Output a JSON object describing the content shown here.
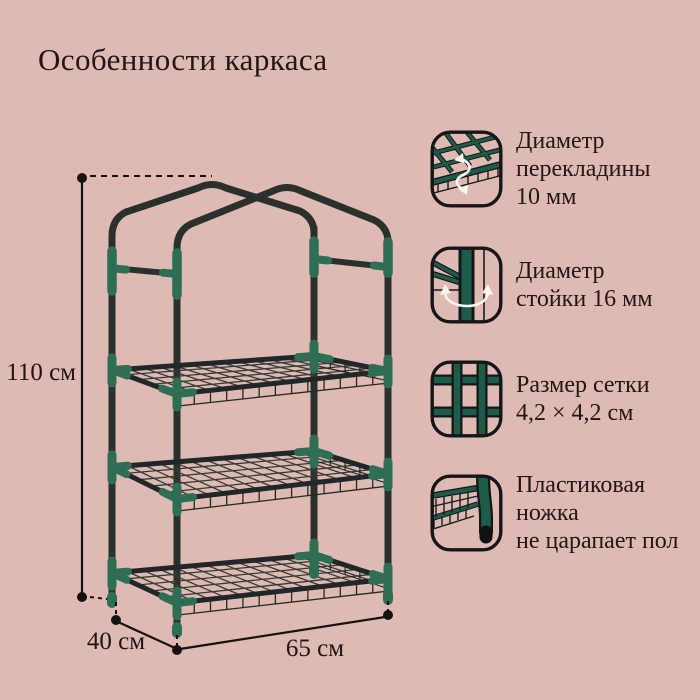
{
  "title": "Особенности каркаса",
  "colors": {
    "background": "#debab3",
    "tube_dark_green": "#2a302c",
    "connector_teal": "#2d6e55",
    "icon_green": "#1e5c49",
    "text": "#20161a",
    "arrow_white": "#fbf6f1"
  },
  "dimensions": {
    "height_label": "110 см",
    "depth_label": "40 см",
    "width_label": "65 см"
  },
  "features": [
    {
      "icon": "crossbar-diameter-icon",
      "lines": [
        "Диаметр",
        "перекладины",
        "10 мм"
      ]
    },
    {
      "icon": "post-diameter-icon",
      "lines": [
        "Диаметр",
        "стойки 16 мм"
      ]
    },
    {
      "icon": "mesh-size-icon",
      "lines": [
        "Размер сетки",
        "4,2 × 4,2 см"
      ]
    },
    {
      "icon": "plastic-foot-icon",
      "lines": [
        "Пластиковая",
        "ножка",
        "не царапает пол"
      ]
    }
  ]
}
